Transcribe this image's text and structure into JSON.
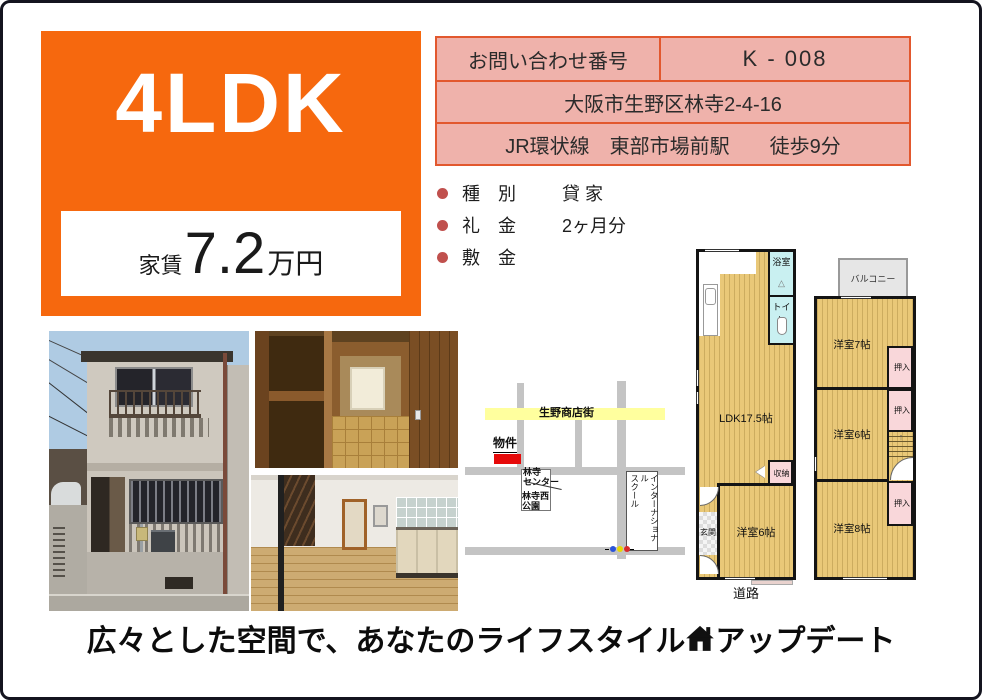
{
  "colors": {
    "accent_orange": "#F6680E",
    "table_bg": "#EFB2AB",
    "table_border": "#E2582E",
    "bullet_red": "#C0504D",
    "floor_tan": "#E9C878",
    "wet_area_cyan": "#C9F0F1",
    "closet_pink": "#F9D7DA",
    "map_road_gray": "#C4C4C4",
    "shopping_street_yellow": "#FFFF9E",
    "property_marker_red": "#E60A0A"
  },
  "hero": {
    "layout": "4LDK",
    "rent_label": "家賃",
    "rent_value": "7.2",
    "rent_unit": "万円"
  },
  "info": {
    "inquiry_label": "お問い合わせ番号",
    "inquiry_value": "K - 008",
    "address": "大阪市生野区林寺2-4-16",
    "access": "JR環状線　東部市場前駅　　徒歩9分"
  },
  "details": [
    {
      "label": "種　別",
      "value": "貸 家"
    },
    {
      "label": "礼　金",
      "value": "2ヶ月分"
    },
    {
      "label": "敷　金",
      "value": ""
    }
  ],
  "map": {
    "street": "生野商店街",
    "property": "物件",
    "center": "林寺\nセンター",
    "park": "林寺西\n公園",
    "school": "インターナショナル\nスクール"
  },
  "floorplan": {
    "f1": {
      "ldk": "LDK17.5帖",
      "bath": "浴室",
      "bath_mark": "△",
      "toilet": "トイレ",
      "storage": "収納",
      "entrance": "玄関",
      "room6": "洋室6帖",
      "road": "道路"
    },
    "f2": {
      "balcony": "バルコニー",
      "room7": "洋室7帖",
      "closet": "押入",
      "room6": "洋室6帖",
      "room8": "洋室8帖",
      "stairs_up_arrow": "↑"
    }
  },
  "tagline": {
    "pre": "広々とした空間で、あなたのライフスタイル",
    "post": "アップデート"
  },
  "icons": {
    "tagline_house": "house-icon",
    "traffic_light": "traffic-light-icon"
  }
}
